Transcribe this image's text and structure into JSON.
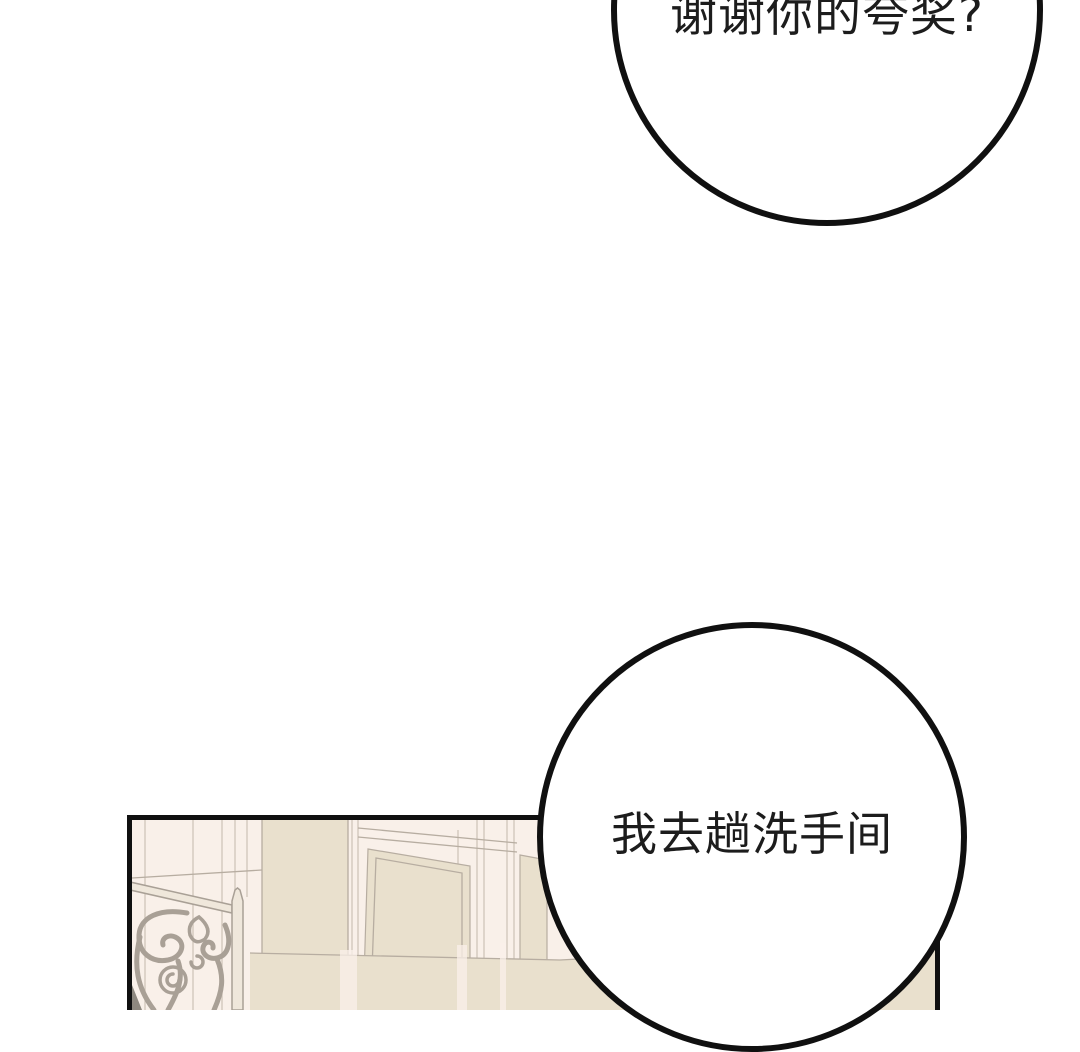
{
  "scene": {
    "background": "#ffffff",
    "outline": "#101010",
    "text_color": "#1c1c1c"
  },
  "speech": {
    "top_bubble": {
      "text": "谢谢你的夸奖?"
    },
    "bottom_bubble": {
      "text": "我去趟洗手间"
    }
  },
  "panel": {
    "description": "hallway wall with moldings, doors and wrought-iron stair railing",
    "colors": {
      "wall": "#f9f0e9",
      "wall_line": "#cfc5ba",
      "molding_line": "#b7ada1",
      "beige": "#e9e0cd",
      "iron": "#a9a096",
      "iron_fill": "#efe7db",
      "iron_dark": "#8e887f"
    }
  }
}
